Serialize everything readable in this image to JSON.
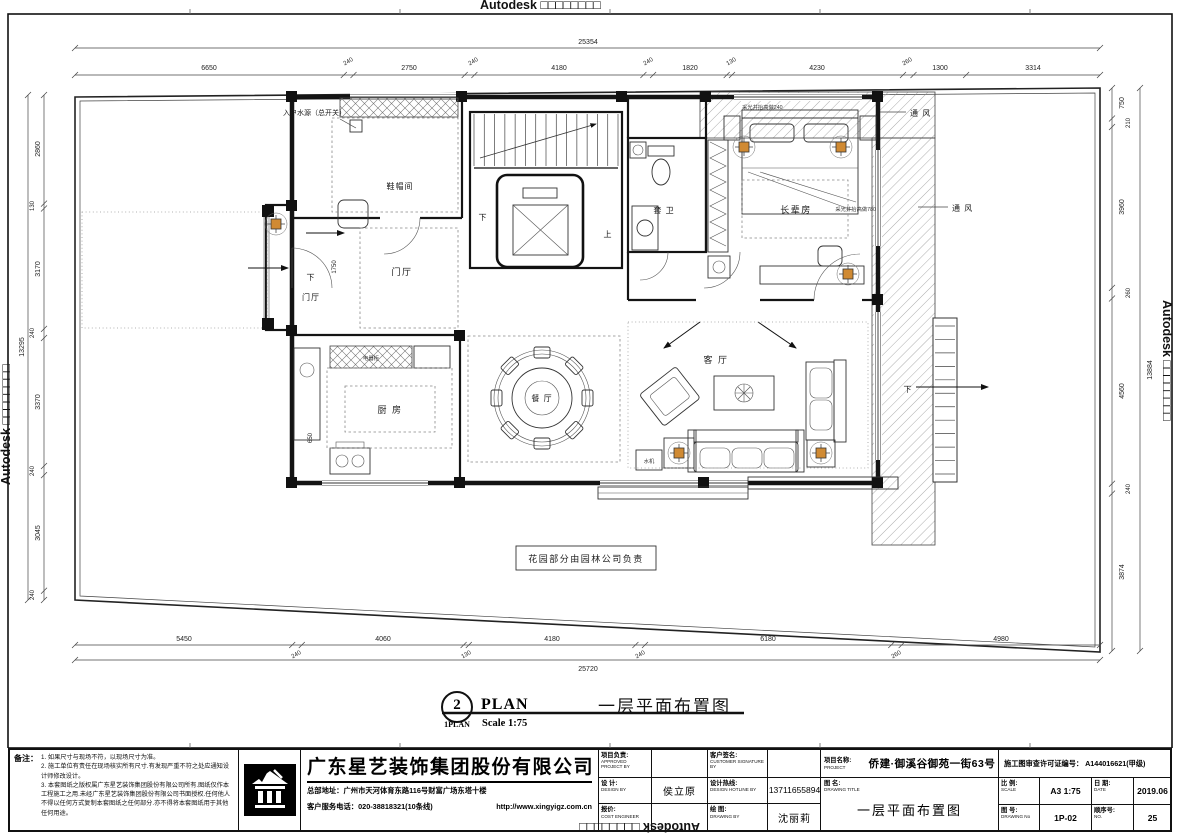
{
  "sheet": {
    "watermark": "Autodesk □□□□□□□□"
  },
  "plan": {
    "labels": {
      "water_source": "入户水源（总开关）",
      "shoe_room": "鞋帽间",
      "foyer_main": "门厅",
      "foyer_porch": "门厅",
      "down_porch": "下",
      "down_stairs": "下",
      "up_stairs": "上",
      "down_right": "下",
      "bath": "套 卫",
      "elder_room": "长辈房",
      "vent_top": "通 风",
      "vent_right": "通 风",
      "lightwell_top": "采光井抬高做240",
      "lightwell_right": "采光井抬高做780",
      "kitchen": "厨 房",
      "appliance_cabinet": "电器柜",
      "dining": "餐 厅",
      "living": "客 厅",
      "water_machine": "水机",
      "garden_note": "花园部分由园林公司负责"
    },
    "title": {
      "bubble_no": "2",
      "bubble_ref": "1PLAN",
      "name": "PLAN",
      "scale": "Scale  1:75",
      "cn": "一层平面布置图"
    }
  },
  "dims": {
    "top": {
      "overall": "25354",
      "segments": [
        "6650",
        "240",
        "2750",
        "240",
        "4180",
        "240",
        "1820",
        "130",
        "4230",
        "260",
        "1300",
        "3314"
      ]
    },
    "bottom": {
      "overall": "25720",
      "segments": [
        "5450",
        "240",
        "4060",
        "130",
        "4180",
        "240",
        "6180",
        "260",
        "4980"
      ]
    },
    "left": {
      "overall": "13295",
      "segments": [
        "2860",
        "130",
        "3170",
        "240",
        "3370",
        "240",
        "3045",
        "240"
      ]
    },
    "right": {
      "overall": "13884",
      "segments": [
        "750",
        "210",
        "3960",
        "260",
        "4560",
        "240",
        "3874"
      ]
    },
    "interior": {
      "kitchen": "650",
      "foyer": "1750"
    }
  },
  "titleblock": {
    "notes_label": "备注：",
    "note1": "1. 如果尺寸与现场不符，以现场尺寸为准。",
    "note2": "2. 施工单位有责任在现场核实所有尺寸.有发现严重不符之处应通知设计师修改设计。",
    "note3": "3. 本套图纸之版权属广东星艺装饰集团股份有限公司所有.图纸仅作本工程施工之用.未经广东星艺装饰集团股份有限公司书面授权.任何他人不得以任何方式复制本套图纸之任何部分.亦不得将本套图纸用于其他任何用途。",
    "company": {
      "name": "广东星艺装饰集团股份有限公司",
      "address": "总部地址：广州市天河体育东路116号财富广场东塔十楼",
      "phone": "客户服务电话：020-38818321(10条线)",
      "url": "http://www.xingyigz.com.cn"
    },
    "fields": {
      "approved_cn": "项目负责:",
      "approved_en": "APPROVED PROJECT BY",
      "approved_value": "",
      "customer_cn": "客户签名:",
      "customer_en": "CUSTOMER SIGNATURE BY",
      "customer_value": "",
      "design_cn": "设 计:",
      "design_en": "DESIGN BY",
      "design_value": "侯立原",
      "hotline_cn": "设计热线:",
      "hotline_en": "DESIGN HOTLINE BY",
      "hotline_value": "13711655894",
      "cost_cn": "报价:",
      "cost_en": "COST ENGINEER",
      "cost_value": "",
      "drawn_cn": "绘 图:",
      "drawn_en": "DRAWING BY",
      "drawn_value": "沈丽莉"
    },
    "project": {
      "label_cn": "项目名称:",
      "label_en": "PROJECT",
      "value": "侨建·御溪谷御苑一街63号",
      "title_label_cn": "图 名:",
      "title_label_en": "DRAWING  TITLE",
      "title_value": "一层平面布置图"
    },
    "right": {
      "permit_label": "施工图审查许可证编号：",
      "permit_value": "A144016621(甲级)",
      "scale_cn": "比 例:",
      "scale_en": "SCALE",
      "scale_value": "A3 1:75",
      "date_cn": "日 期:",
      "date_en": "DATE",
      "date_value": "2019.06",
      "no_cn": "图 号:",
      "no_en": "DRAWING No",
      "no_value": "1P-02",
      "seq_cn": "顺序号:",
      "seq_en": "NO.",
      "seq_value": "25"
    }
  }
}
